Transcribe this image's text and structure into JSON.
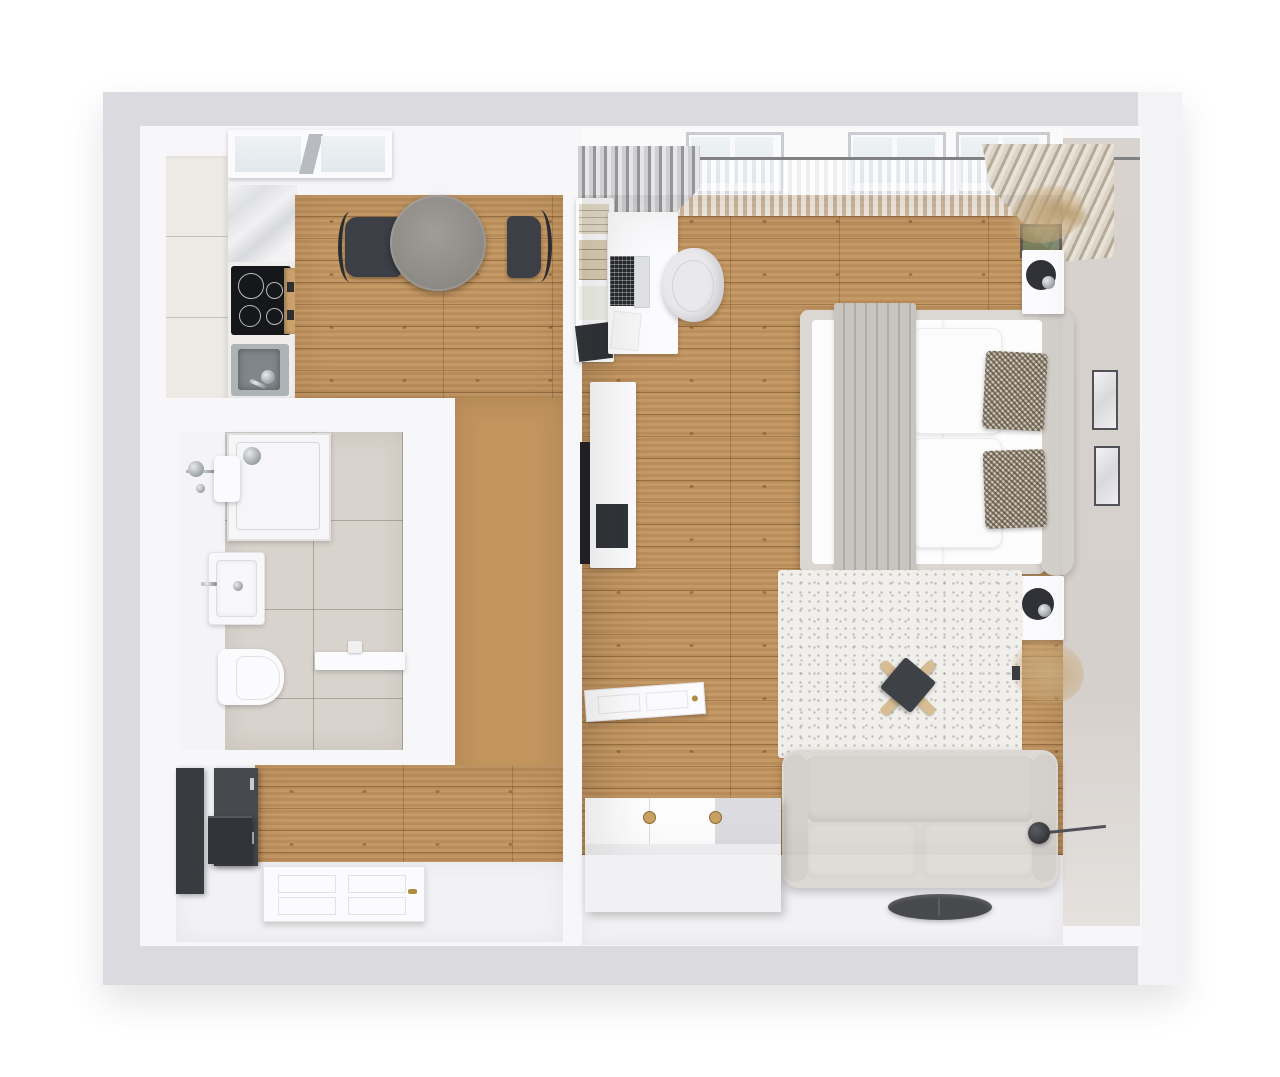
{
  "image_type": "3d-floor-plan-top-down-render",
  "visible_text": [],
  "colors": {
    "slab": "#dbdade",
    "wall": "#f7f7f9",
    "beige-wall": "#d9d3cf",
    "wood": "#c2945e",
    "tile": "#d8d3cc",
    "rug": "#f0efec",
    "dark": "#3a3d42",
    "sofa": "#dcd9d4",
    "bed-frame": "#dbd7d3",
    "blanket": "#c8c5c0",
    "table-gray": "#908d89",
    "cabinet-cream": "#edeae5",
    "brass": "#b08d3e",
    "plant-tan": "#c9ab7d"
  },
  "apartment": {
    "rooms": [
      {
        "name": "kitchen-dining",
        "floor": "wood-planks",
        "items": [
          "skylight-window",
          "tall-cabinet-column",
          "marble-counter",
          "cooktop-4-burners",
          "built-in-oven",
          "kitchen-sink-with-faucet",
          "round-dining-table",
          "dining-chair-left",
          "dining-chair-right"
        ]
      },
      {
        "name": "bathroom",
        "floor": "beige-tiles",
        "items": [
          "shower-tray-with-drain",
          "shower-mixer-chrome",
          "washbasin",
          "toilet",
          "counter-shelf-with-faucet"
        ]
      },
      {
        "name": "entry-hall",
        "floor": "wood-planks",
        "items": [
          "dark-wardrobe-tall",
          "dark-cabinet-with-drawers",
          "dark-storage-box",
          "front-door-white-brass-handle"
        ]
      },
      {
        "name": "bedroom-living",
        "floor": "wood-planks",
        "items": [
          "window-wall-with-sheer-curtain",
          "gray-curtain",
          "beige-curtain",
          "dried-plant-corner",
          "book-shelf",
          "desk",
          "laptop",
          "desk-chair-white",
          "tv-screen",
          "tv-console",
          "interior-door-open",
          "double-bed",
          "gray-throw-blanket",
          "white-pillows",
          "patterned-pillows",
          "headboard",
          "nightstand-top",
          "ball-lamp-top",
          "nightstand-bottom",
          "ball-lamp-bottom",
          "picture-frame-upper",
          "picture-frame-lower",
          "area-rug",
          "x-leg-stool",
          "dried-plant-floor",
          "sofa-two-seat",
          "white-dresser-two-knobs",
          "floor-lamp",
          "round-floor-tray"
        ]
      }
    ]
  }
}
